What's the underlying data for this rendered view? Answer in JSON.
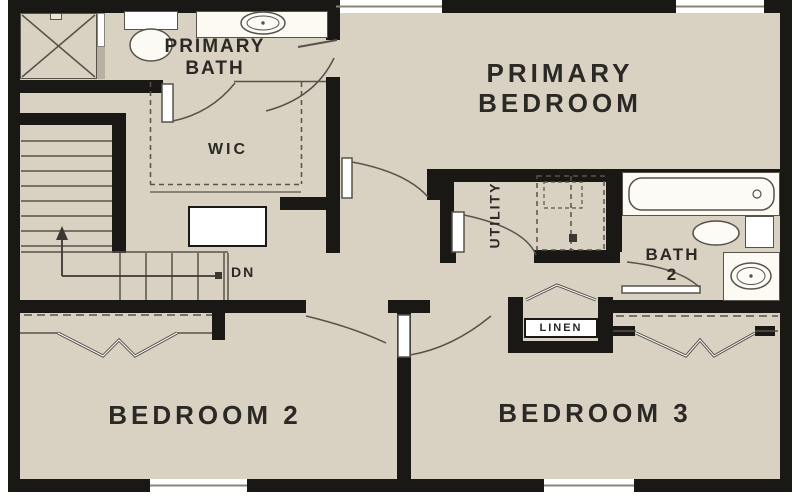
{
  "meta": {
    "drawing_type": "residential floor plan",
    "level": "upper floor"
  },
  "colors": {
    "floor": "#d9d1c1",
    "wall": "#1a1815",
    "thin_line": "#57534b",
    "fixture_fill": "#fcfaf3",
    "text": "#2b2925"
  },
  "rooms": {
    "primary_bedroom": {
      "name": "Primary Bedroom",
      "label_line1": "PRIMARY",
      "label_line2": "BEDROOM"
    },
    "primary_bath": {
      "name": "Primary Bath",
      "label_line1": "PRIMARY",
      "label_line2": "BATH"
    },
    "wic": {
      "name": "Walk-in Closet",
      "label": "WIC"
    },
    "utility": {
      "name": "Utility",
      "label": "UTILITY"
    },
    "bath2": {
      "name": "Bath 2",
      "label_line1": "BATH",
      "label_line2": "2"
    },
    "linen": {
      "name": "Linen Closet",
      "label": "LINEN"
    },
    "bedroom2": {
      "name": "Bedroom 2",
      "label": "BEDROOM 2"
    },
    "bedroom3": {
      "name": "Bedroom 3",
      "label": "BEDROOM 3"
    }
  },
  "stairs": {
    "direction_label": "DN"
  },
  "fixtures": [
    "shower",
    "primary-bath-toilet",
    "primary-bath-sink",
    "washer-dryer",
    "bathtub",
    "bath2-toilet",
    "bath2-sink",
    "dresser"
  ],
  "windows": {
    "count": 4
  }
}
